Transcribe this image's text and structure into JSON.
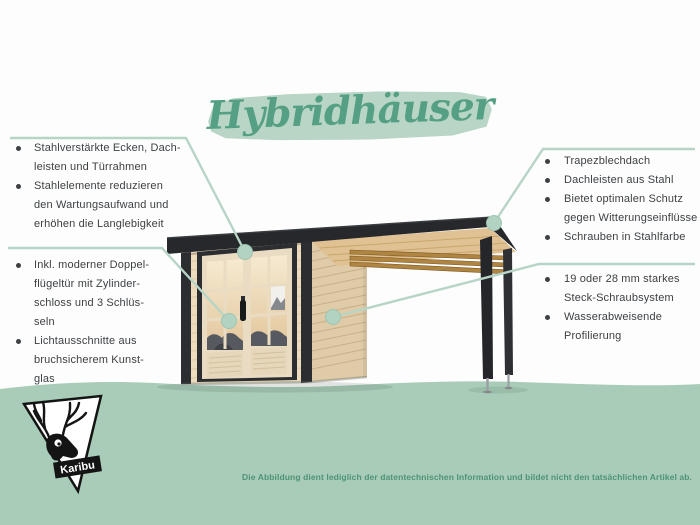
{
  "title": "Hybridhäuser",
  "callouts": {
    "top_left": {
      "items": [
        "Stahlverstärkte Ecken, Dach-\nleisten und Türrahmen",
        "Stahlelemente reduzieren\nden Wartungsaufwand und\nerhöhen die Langlebigkeit"
      ]
    },
    "bottom_left": {
      "items": [
        "Inkl. moderner Doppel-\nflügeltür mit Zylinder-\nschloss und 3 Schlüs-\nseln",
        "Lichtausschnitte aus\nbruchsicherem Kunst-\nglas"
      ]
    },
    "top_right": {
      "items": [
        "Trapezblechdach",
        "Dachleisten aus Stahl",
        "Bietet optimalen Schutz\ngegen Witterungseinflüsse",
        "Schrauben in Stahlfarbe"
      ]
    },
    "bottom_right": {
      "items": [
        "19 oder 28 mm starkes\nSteck-Schraubsystem",
        "Wasserabweisende\nProfilierung"
      ]
    }
  },
  "logo": {
    "label": "Karibu"
  },
  "disclaimer": "Die Abbildung dient lediglich der datentechnischen Information und bildet nicht den tatsächlichen Artikel ab.",
  "colors": {
    "ground_green": "#a8ccb8",
    "accent_sage": "#b7d5c6",
    "title_green": "#55a084",
    "disclaimer_green": "#4e9375",
    "text_gray": "#3d4144",
    "roof_black": "#26282b",
    "wood_light": "#ecdcbd"
  }
}
